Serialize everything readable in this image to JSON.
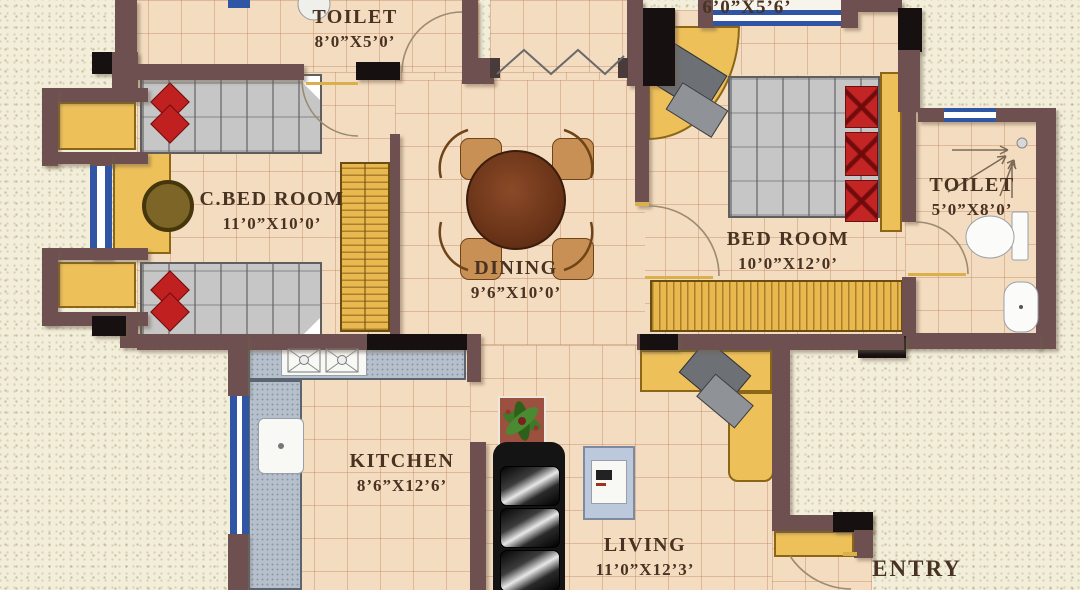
{
  "rooms": [
    {
      "name": "TOILET",
      "size": "8’0”X5’0’"
    },
    {
      "name": "",
      "size": "6’0”X5’6’"
    },
    {
      "name": "C.BED ROOM",
      "size": "11’0”X10’0’"
    },
    {
      "name": "DINING",
      "size": "9’6”X10’0’"
    },
    {
      "name": "BED ROOM",
      "size": "10’0”X12’0’"
    },
    {
      "name": "TOILET",
      "size": "5’0”X8’0’"
    },
    {
      "name": "KITCHEN",
      "size": "8’6”X12’6’"
    },
    {
      "name": "LIVING",
      "size": "11’0”X12’3’"
    },
    {
      "name": "ENTRY",
      "size": ""
    }
  ],
  "colors": {
    "wall": "#6f5050",
    "column": "#161010",
    "floor_tile": "#f4dcc0",
    "outside": "#f2eeda",
    "window_blue": "#2f55a4",
    "furniture_wood": "#eec05a",
    "pillow_red": "#c02020",
    "counter_gray": "#b6c0cc",
    "table_walnut": "#6b3418",
    "label_text": "#483221"
  }
}
